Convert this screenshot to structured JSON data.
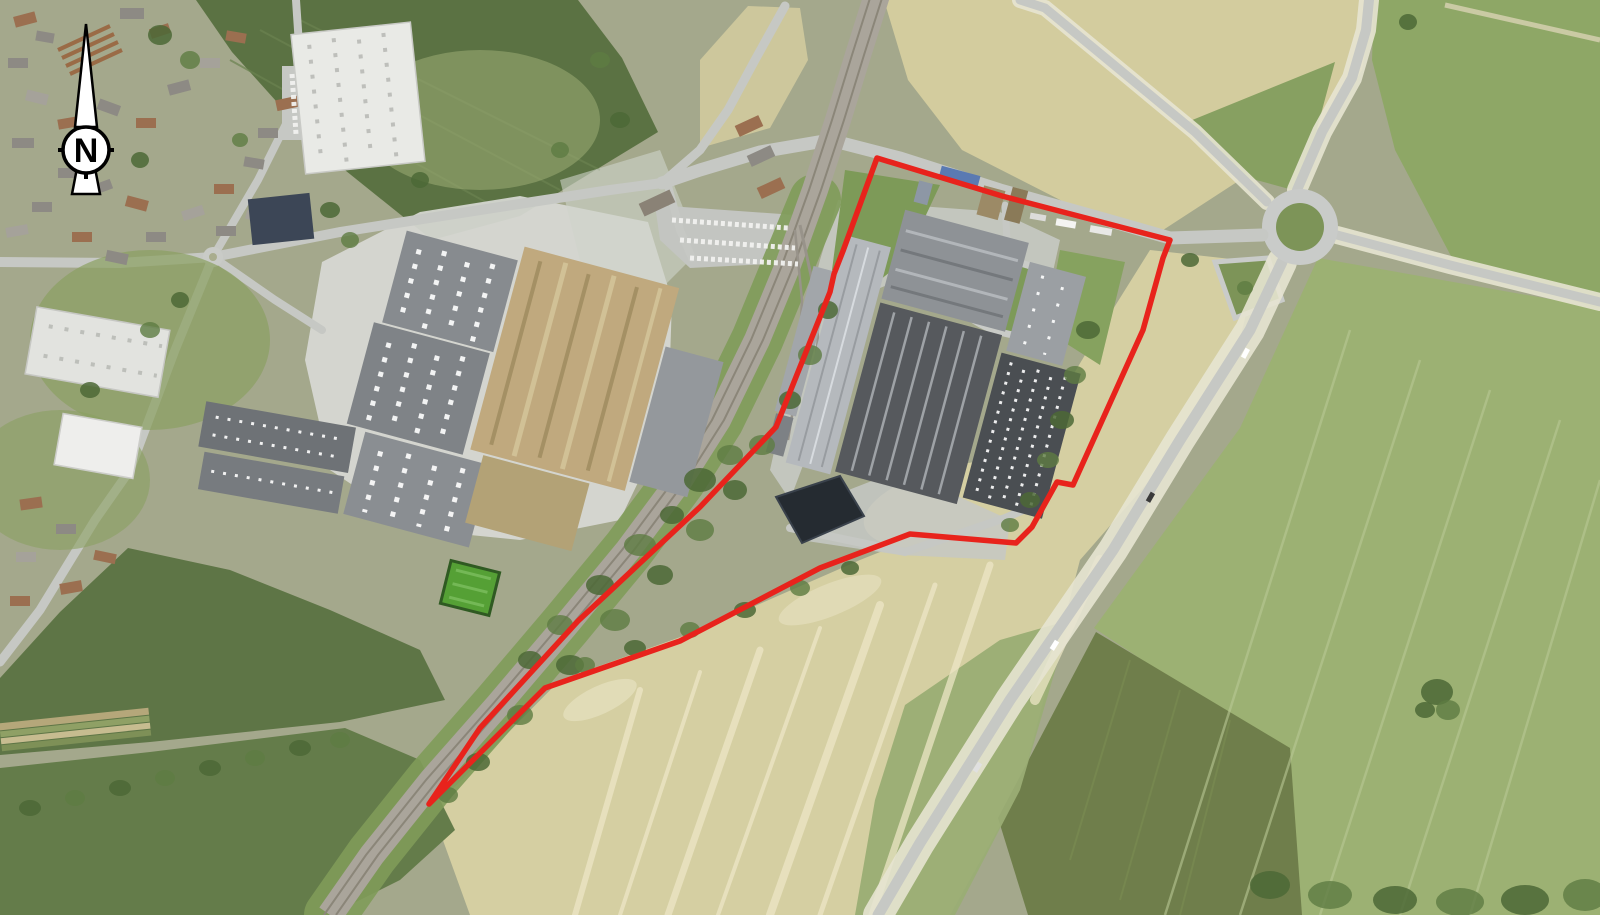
{
  "map": {
    "north_label": "N",
    "site_boundary": {
      "color": "#e8231c",
      "stroke_width": "5.5",
      "points": "877,158 1002,196 1170,240 1163,258 1143,330 1073,485 1057,482 1032,527 1016,543 910,534 820,568 680,641 545,688 429,804 480,728 578,621 700,507 776,427 830,292 834,274 843,251"
    },
    "palette": {
      "boundary_red": "#e8231c",
      "crop_tan": "#d5cfa2",
      "field_green": "#9cb173",
      "field_dark_green": "#5b7243",
      "field_olive": "#6f7e4b",
      "road_gray": "#c6c8c4",
      "railway_gray": "#aaa59b",
      "roof_dark": "#56595d",
      "roof_light": "#b5b9bd",
      "construction_tan": "#c0a97e",
      "pond_dark": "#252b31"
    }
  }
}
